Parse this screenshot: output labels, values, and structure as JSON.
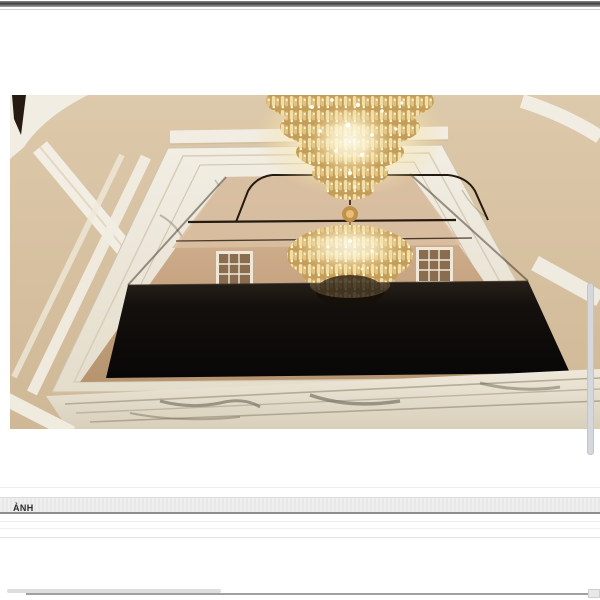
{
  "section": {
    "header": "ẢNH"
  },
  "image": {
    "description": "Interior 3D render: gold crystal chandeliers above a white marble framed ceiling mirror with a black glass panel",
    "colors": {
      "ceiling_beige": "#d7c2a4",
      "marble_white": "#eee9dd",
      "mirror_bronze": "#c8a583",
      "panel_black": "#0d0b09",
      "chandelier_gold": "#f1dfa6"
    }
  }
}
